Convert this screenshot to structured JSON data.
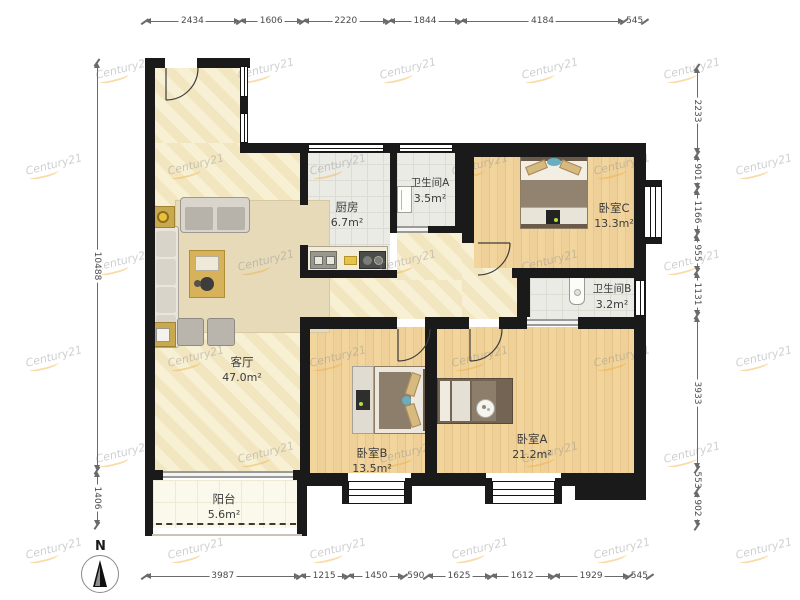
{
  "rooms": [
    {
      "id": "living",
      "name": "客厅",
      "area": "47.0m²"
    },
    {
      "id": "kitchen",
      "name": "厨房",
      "area": "6.7m²"
    },
    {
      "id": "bathA",
      "name": "卫生间A",
      "area": "3.5m²"
    },
    {
      "id": "bedC",
      "name": "卧室C",
      "area": "13.3m²"
    },
    {
      "id": "bathB",
      "name": "卫生间B",
      "area": "3.2m²"
    },
    {
      "id": "bedB",
      "name": "卧室B",
      "area": "13.5m²"
    },
    {
      "id": "bedA",
      "name": "卧室A",
      "area": "21.2m²"
    },
    {
      "id": "balcony",
      "name": "阳台",
      "area": "5.6m²"
    }
  ],
  "dimensions_mm": {
    "top": [
      2434,
      1606,
      2220,
      1844,
      4184,
      545
    ],
    "bottom": [
      3987,
      1215,
      1450,
      590,
      1625,
      1612,
      1929,
      545
    ],
    "left": [
      10488,
      1406
    ],
    "right": [
      2233,
      901,
      1166,
      955,
      1131,
      3933,
      553,
      902
    ]
  },
  "compass": {
    "label": "N"
  },
  "watermark": {
    "text": "Century21"
  },
  "colors": {
    "wall": "#1a1a1a",
    "wood_floor": "#efd099",
    "beige_floor": "#f7eed0",
    "tile_floor": "#ebebe6",
    "watermark_orange": "#eea832",
    "dimension": "#6a6a6a"
  }
}
